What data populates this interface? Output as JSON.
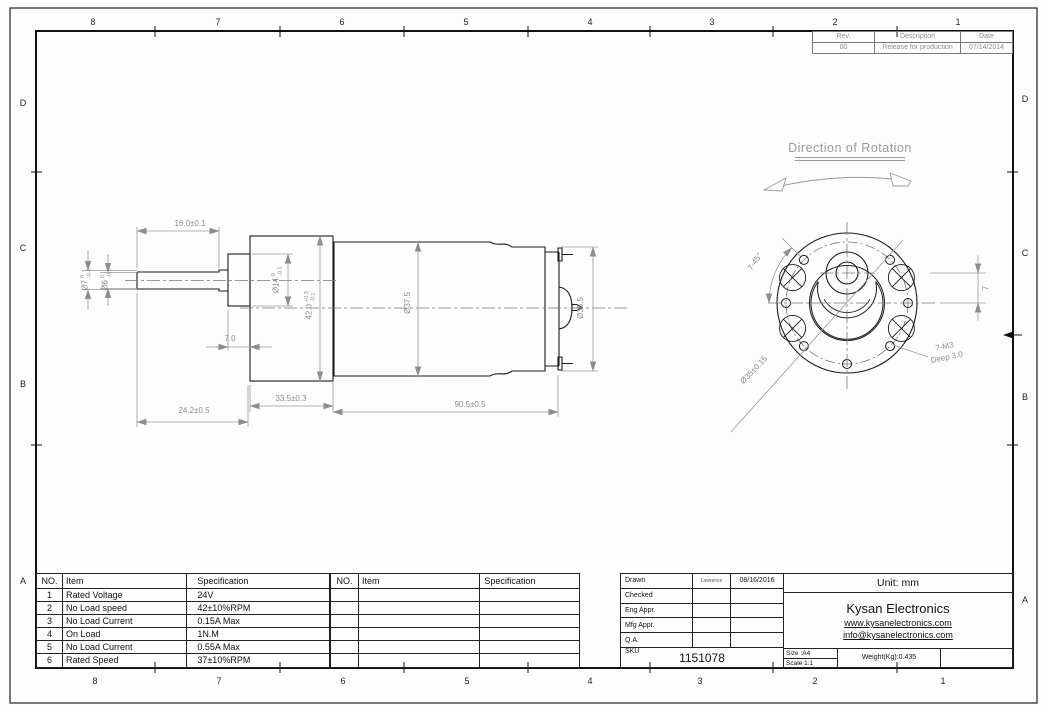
{
  "sheet": {
    "grid": {
      "cols": [
        "8",
        "7",
        "6",
        "5",
        "4",
        "3",
        "2",
        "1"
      ],
      "rows": [
        "D",
        "C",
        "B",
        "A"
      ]
    }
  },
  "revision_table": {
    "headers": [
      "Rev.",
      "Description",
      "Date"
    ],
    "rows": [
      [
        "00",
        "Release for production",
        "07/14/2014"
      ]
    ]
  },
  "annotations": {
    "direction_of_rotation": "Direction of Rotation"
  },
  "side_view": {
    "dims": {
      "shaft_length": "16.0±0.1",
      "boss_length": "7.0",
      "front_length": "24.2±0.5",
      "gearbox_length": "33.5±0.3",
      "motor_length": "90.5±0.5",
      "motor_diameter": "Ø37.5",
      "endcap_diameter": "Ø35.5",
      "shaft_dia_outer": {
        "nominal": "Ø7",
        "tol_hi": "0",
        "tol_lo": "-0.3"
      },
      "shaft_dia_tip": {
        "nominal": "Ø6",
        "tol_hi": "0",
        "tol_lo": "-0.1"
      },
      "boss_diameter": {
        "nominal": "Ø14",
        "tol_hi": "0",
        "tol_lo": "-0.1"
      },
      "gearbox_diameter": {
        "nominal": "42.0",
        "tol_hi": "+0.3",
        "tol_lo": "-0.1"
      }
    }
  },
  "front_view": {
    "dims": {
      "hole_pattern_angle": "7-45°",
      "bolt_circle": "Ø35±0.15",
      "tap_callout_line1": "7-M3",
      "tap_callout_line2": "Deep 3.0",
      "shaft_offset": "7"
    }
  },
  "spec_table": {
    "headers": {
      "no": "NO.",
      "item": "Item",
      "spec": "Specification"
    },
    "rows": [
      {
        "no": "1",
        "item": "Rated Voltage",
        "spec": "24V"
      },
      {
        "no": "2",
        "item": "No Load speed",
        "spec": "42±10%RPM"
      },
      {
        "no": "3",
        "item": "No Load Current",
        "spec": "0.15A Max"
      },
      {
        "no": "4",
        "item": "On Load",
        "spec": "1N.M"
      },
      {
        "no": "5",
        "item": "No Load Current",
        "spec": "0.55A Max"
      },
      {
        "no": "6",
        "item": "Rated Speed",
        "spec": "37±10%RPM"
      }
    ]
  },
  "title_block": {
    "approvals": [
      {
        "label": "Drawn",
        "name": "Lawrence",
        "date": "08/16/2016"
      },
      {
        "label": "Checked",
        "name": "",
        "date": ""
      },
      {
        "label": "Eng Appr.",
        "name": "",
        "date": ""
      },
      {
        "label": "Mfg Appr.",
        "name": "",
        "date": ""
      },
      {
        "label": "Q.A.",
        "name": "",
        "date": ""
      }
    ],
    "sku_label": "SKU",
    "sku_value": "1151078",
    "unit": "Unit: mm",
    "company": "Kysan Electronics",
    "website": "www.kysanelectronics.com",
    "email": "info@kysanelectronics.com",
    "size": "Size :A4",
    "scale": "Scale 1:1",
    "weight": "Weight(Kg):0.435"
  },
  "colors": {
    "object_line": "#1a1a1a",
    "dimension": "#8c8c8c",
    "centerline": "#777777"
  }
}
